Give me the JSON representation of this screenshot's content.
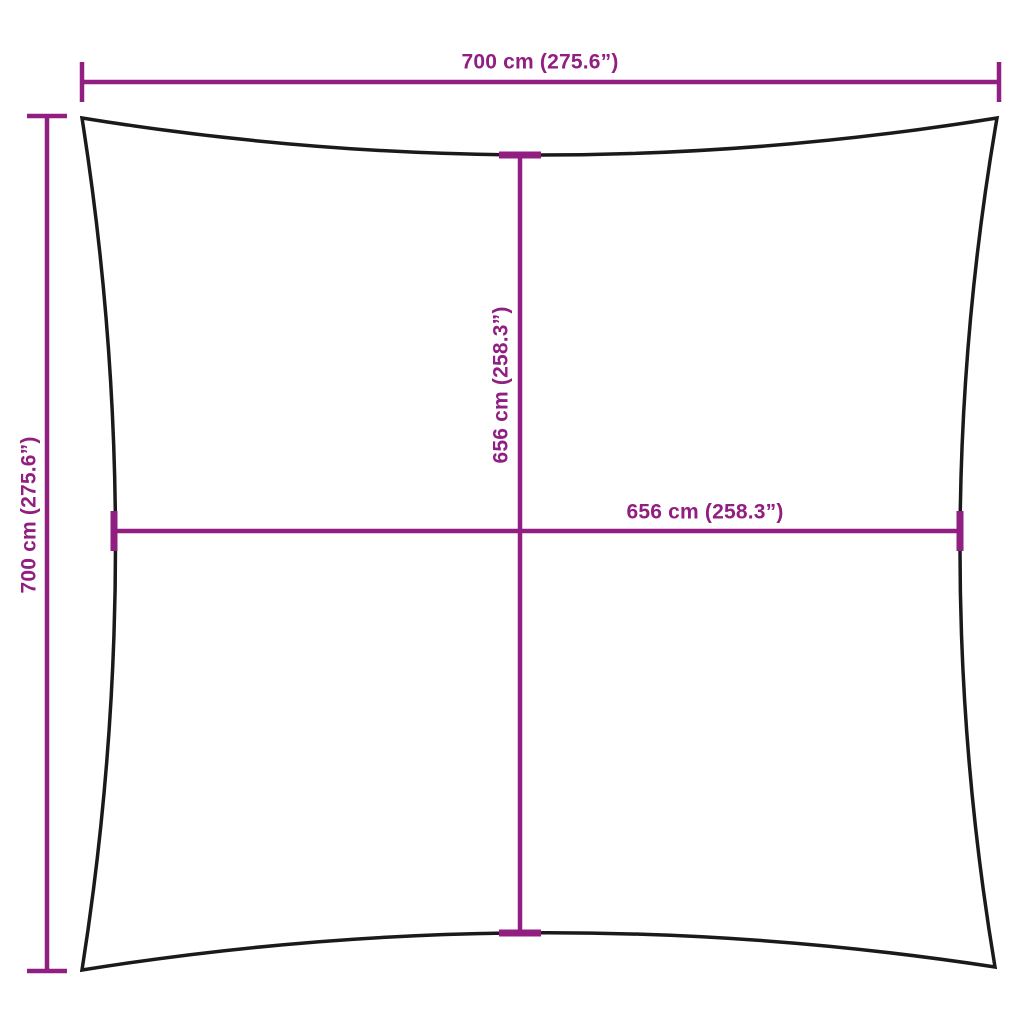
{
  "diagram": {
    "labels": {
      "top_width": "700 cm (275.6”)",
      "left_height": "700 cm (275.6”)",
      "inner_height": "656 cm (258.3”)",
      "inner_width": "656 cm (258.3”)"
    },
    "colors": {
      "dimension": "#911E81",
      "outline": "#1A1A1A",
      "background": "#FFFFFF"
    }
  }
}
